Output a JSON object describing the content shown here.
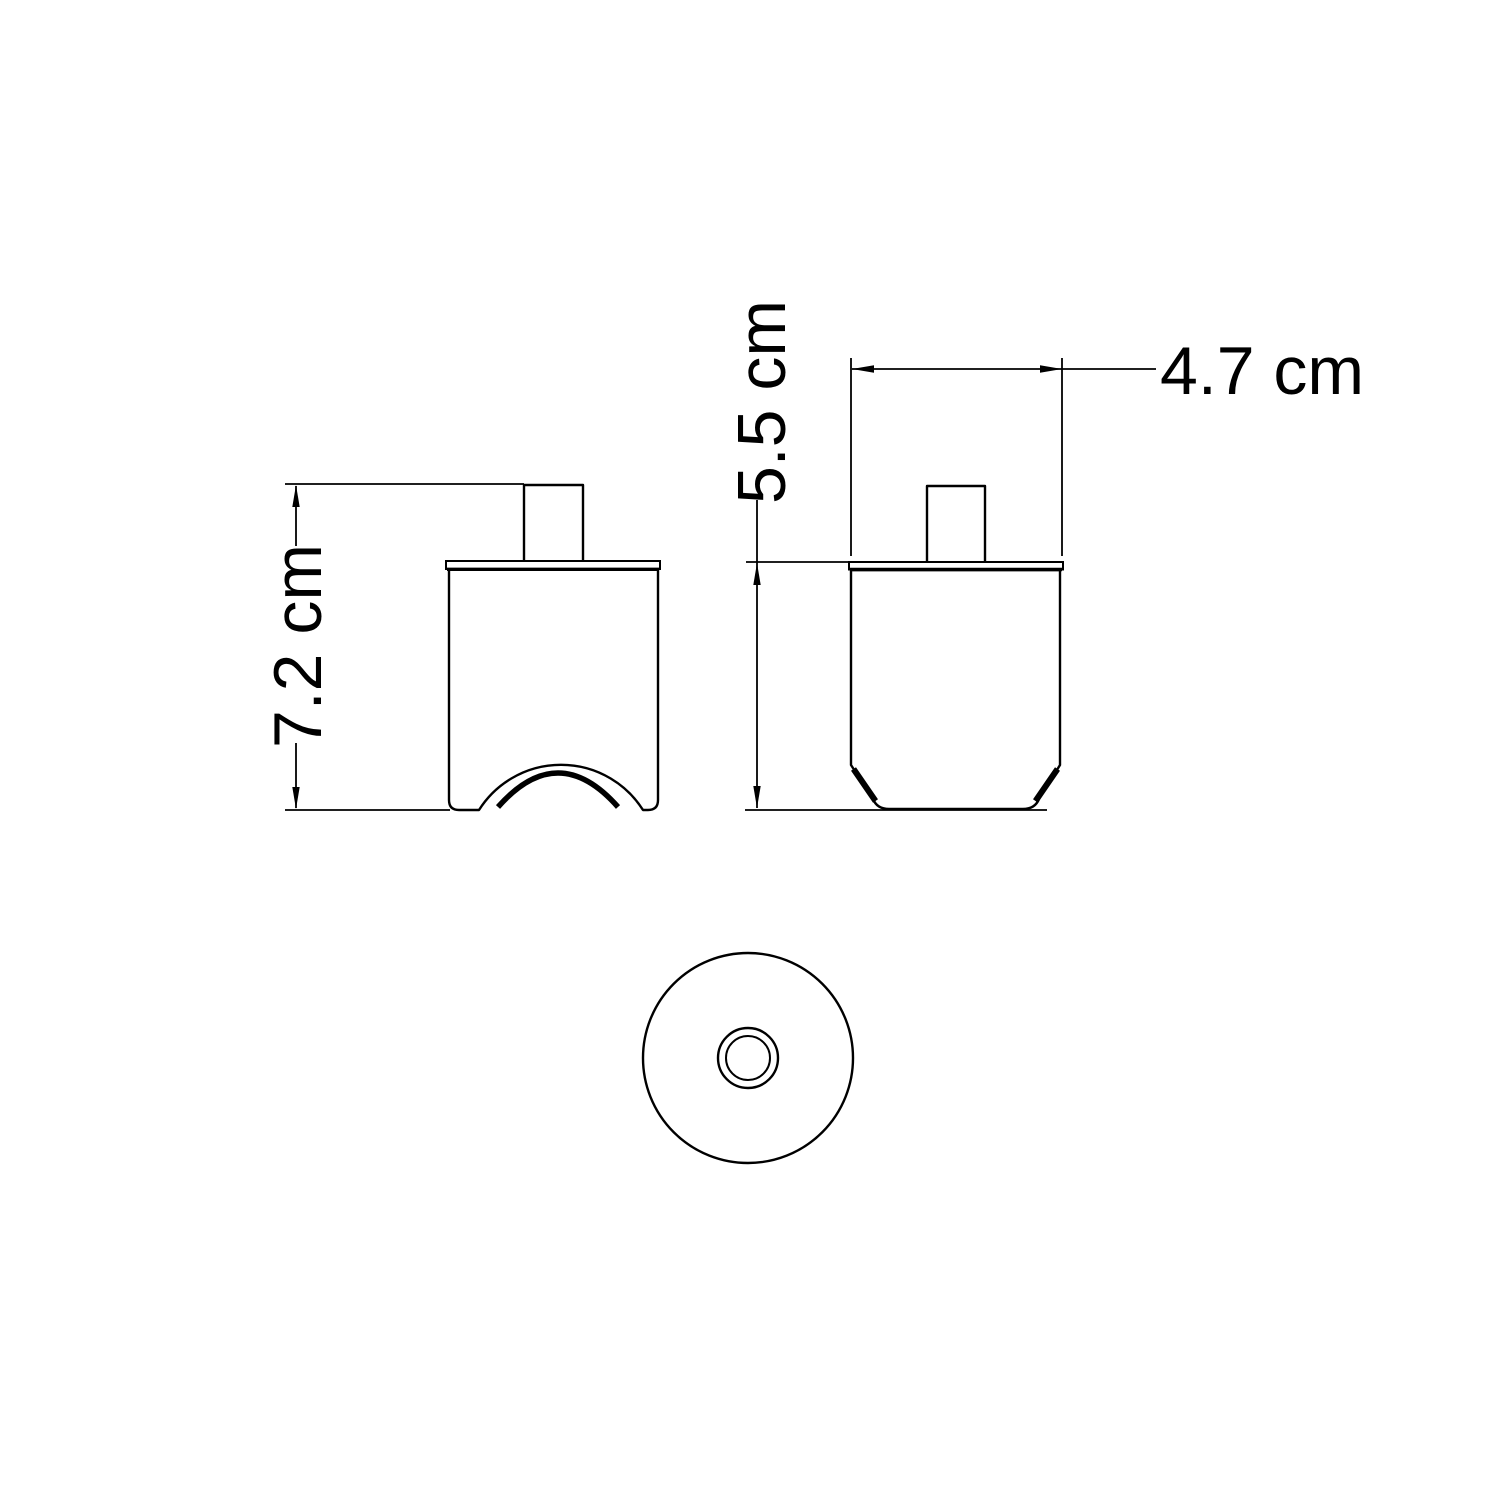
{
  "drawing": {
    "background_color": "#ffffff",
    "line_color": "#000000",
    "dimensions": {
      "front_height": "7.2 cm",
      "side_body_height": "5.5 cm",
      "side_width": "4.7 cm"
    }
  }
}
